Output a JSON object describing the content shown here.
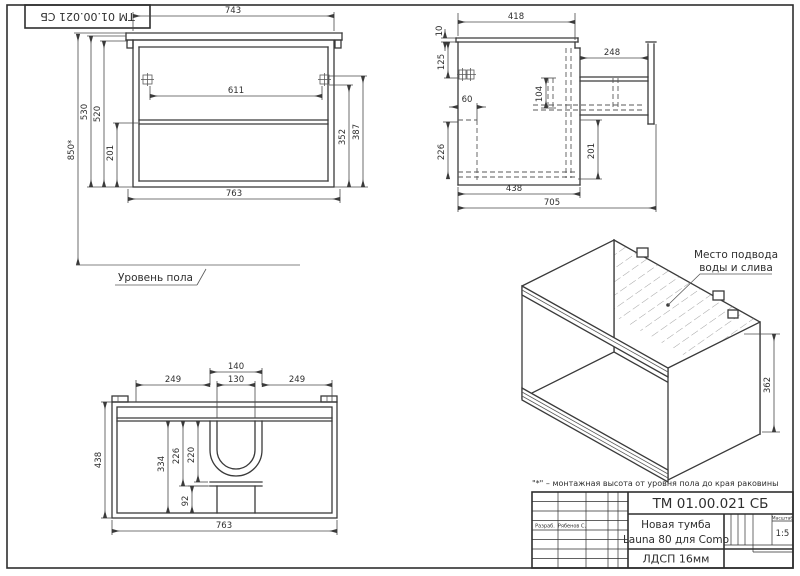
{
  "colors": {
    "line": "#3a3a3a",
    "background": "#ffffff"
  },
  "frame": {
    "designation_rotated": "ТМ 01.00.021 СБ"
  },
  "front_view": {
    "w_top": "743",
    "w_hinge": "611",
    "w_bottom": "763",
    "h_mount": "850*",
    "h_530": "530",
    "h_520": "520",
    "h_201": "201",
    "h_352": "352",
    "h_387": "387",
    "floor_label": "Уровень пола"
  },
  "side_view": {
    "d_418": "418",
    "d_10": "10",
    "d_125": "125",
    "d_248": "248",
    "d_104": "104",
    "d_60": "60",
    "d_226": "226",
    "d_201": "201",
    "d_438": "438",
    "d_705": "705"
  },
  "top_view": {
    "d_140": "140",
    "d_130": "130",
    "d_249l": "249",
    "d_249r": "249",
    "d_438": "438",
    "d_334": "334",
    "d_226": "226",
    "d_220": "220",
    "d_92": "92",
    "d_763": "763"
  },
  "iso_view": {
    "note_line1": "Место подвода",
    "note_line2": "воды и слива",
    "d_362": "362"
  },
  "footnote": "\"*\" – монтажная высота от уровня пола до края раковины",
  "title_block": {
    "designation": "ТМ 01.00.021 СБ",
    "product_line1": "Новая тумба",
    "product_line2": "Launa 80 для Como",
    "material": "ЛДСП 16мм",
    "scale_label": "Масштаб",
    "scale_value": "1:5",
    "sig_role": "Разраб.",
    "sig_name": "Рябенов С."
  }
}
